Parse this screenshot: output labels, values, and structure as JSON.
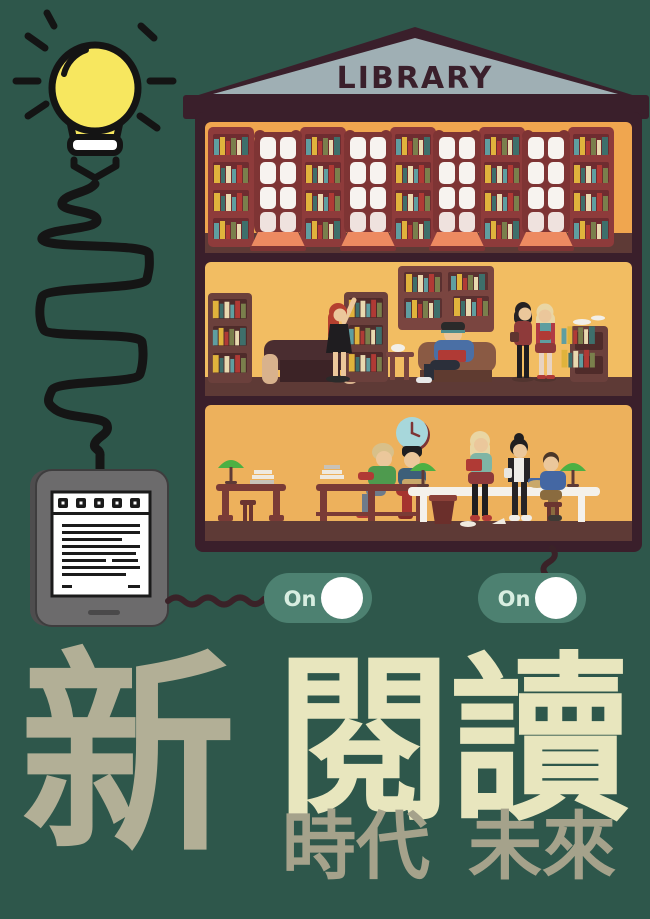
{
  "background_color": "#2E574B",
  "library": {
    "sign_text": "LIBRARY",
    "floors": [
      {
        "name": "top-stacks",
        "description_items": [
          "bookshelves",
          "arched-windows"
        ]
      },
      {
        "name": "browsing-floor",
        "description_items": [
          "bookshelves",
          "armchairs",
          "readers-standing",
          "reader-seated"
        ]
      },
      {
        "name": "reading-room",
        "description_items": [
          "desks",
          "reading-lamps",
          "wall-clock",
          "readers"
        ]
      }
    ]
  },
  "toggles": [
    {
      "label": "On",
      "state": "on"
    },
    {
      "label": "On",
      "state": "on"
    }
  ],
  "headline": {
    "primary": "新",
    "secondary": "閱讀"
  },
  "subheadline": {
    "first": "時代",
    "second": "未來"
  },
  "colors": {
    "background": "#2E574B",
    "building_frame": "#3A1F2B",
    "pediment": "#9FAFB4",
    "sign_text": "#3A1F2B",
    "wall_top_floor": "#F0A64F",
    "wall_middle_floor": "#F2BD62",
    "wall_bottom_floor": "#EDB15C",
    "floor_strip": "#5E3A36",
    "shelf_maroon": "#8E3B3B",
    "bulb_yellow": "#F7E75F",
    "cord_black": "#151515",
    "cord_maroon": "#3A2228",
    "ereader_body": "#6C6B6C",
    "toggle_pill": "#4D8171",
    "toggle_label": "#D8EEE1",
    "toggle_knob": "#FFFFFF",
    "clock_face": "#A7D7DB",
    "lamp_green": "#4CB043",
    "headline_primary": "#B2AF96",
    "headline_secondary": "#E8E6BE",
    "subheadline": "#A5A28B"
  },
  "icons": {
    "bulb": "lightbulb-icon",
    "ereader": "ereader-icon",
    "toggle_knob": "toggle-knob-icon",
    "clock": "wall-clock-icon"
  }
}
